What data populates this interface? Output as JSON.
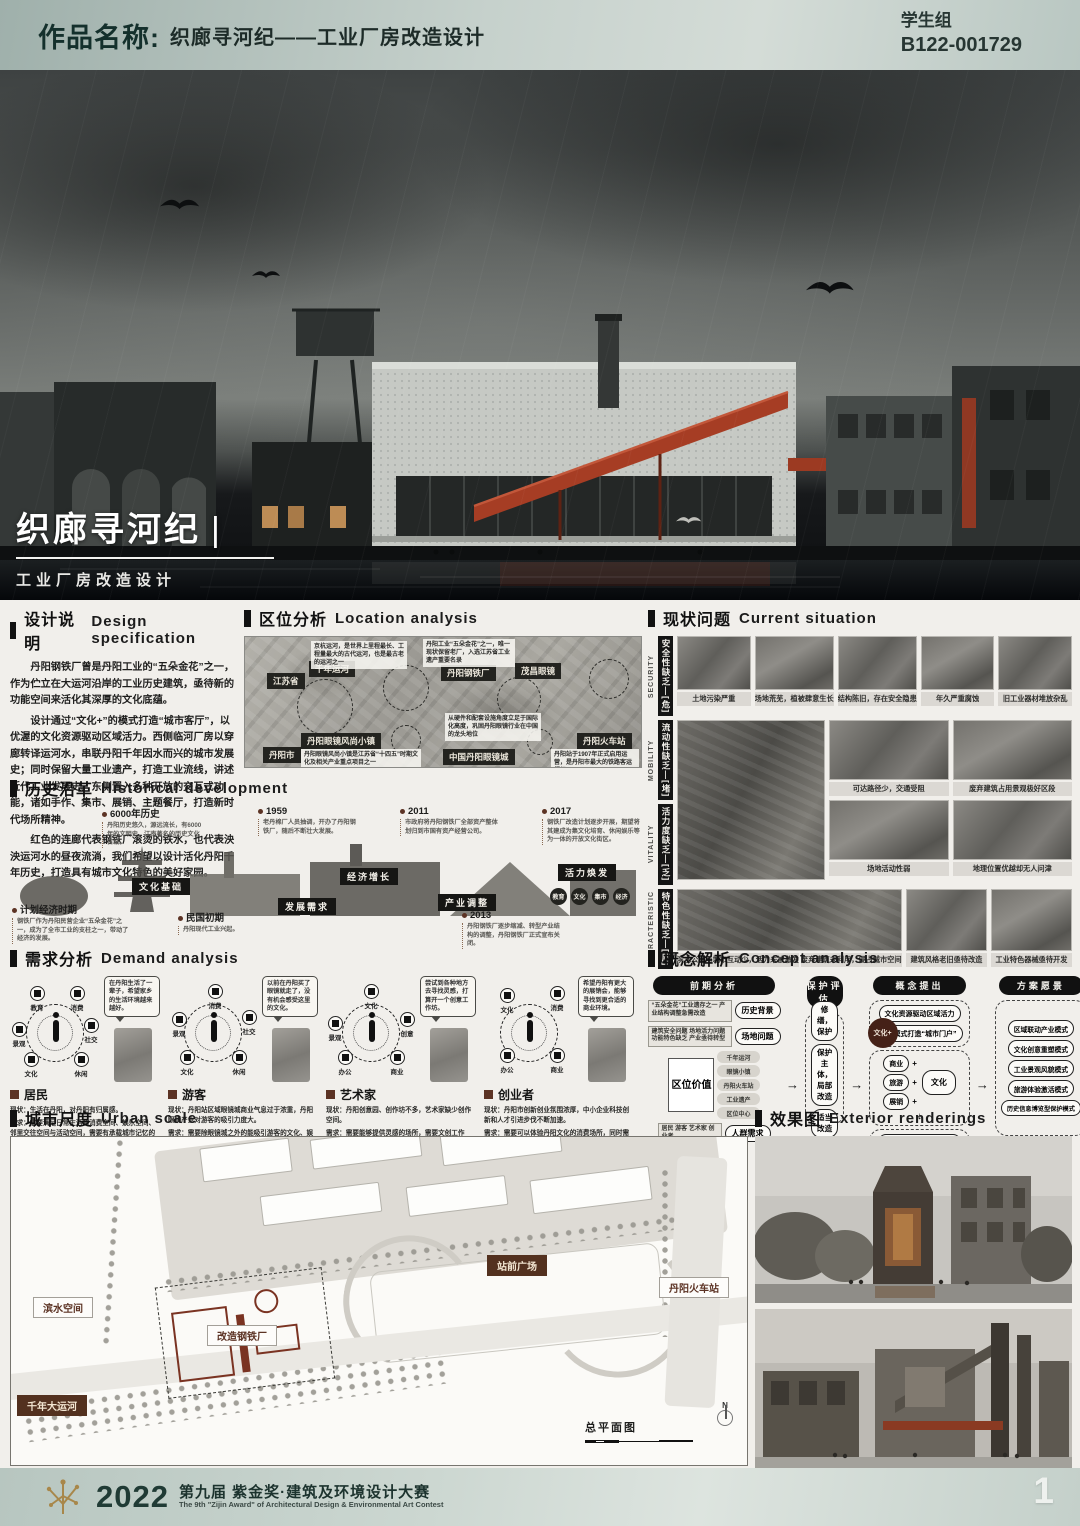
{
  "header": {
    "label": "作品名称:",
    "title": "织廊寻河纪——工业厂房改造设计",
    "group": "学生组",
    "code": "B122-001729"
  },
  "hero": {
    "title": "织廊寻河纪",
    "bar": "|",
    "subtitle": "工业厂房改造设计"
  },
  "design_spec": {
    "zh": "设计说明",
    "en": "Design specification",
    "p1": "丹阳钢铁厂曾是丹阳工业的“五朵金花”之一，作为伫立在大运河沿岸的工业历史建筑，亟待新的功能空间来活化其深厚的文化底蕴。",
    "p2": "设计通过“文化+”的模式打造“城市客厅”，以优渥的文化资源驱动区域活力。西侧临河厂房以穿廊转译运河水，串联丹阳千年因水而兴的城市发展史；同时保留大量工业遗产，打造工业流线，讲述近代工业发展史。东侧置入多种开放的交互式功能，诸如手作、集市、展销、主题餐厅，打造新时代场所精神。",
    "p3": "红色的连廊代表钢铁厂滚烫的铁水，也代表泱泱运河水的昼夜流淌，我们希望以设计活化丹阳千年历史，打造具有城市文化特色的美好家园。"
  },
  "location": {
    "zh": "区位分析",
    "en": "Location analysis",
    "tags": [
      "江苏省",
      "千年运河",
      "丹阳钢铁厂",
      "茂昌眼镜",
      "丹阳火车站",
      "丹阳市",
      "丹阳眼镜风尚小镇",
      "中国丹阳眼镜城"
    ],
    "notes": [
      "京杭运河，是世界上里程最长、工程量最大的古代运河，也是最古老的运河之一",
      "丹阳工业“五朵金花”之一，唯一现状保留老厂，入选江苏省工业遗产重要名录",
      "丹阳眼镜风尚小镇是江苏省“十四五”时期文化及相关产业重点项目之一",
      "从硬件和配套设施角度立足于国际化高度，巩固丹阳眼镜行业在中国的龙头地位",
      "丹阳站于1907年正式启用运营，是丹阳市最大的铁路客运枢纽"
    ]
  },
  "current": {
    "zh": "现状问题",
    "en": "Current situation",
    "rows": [
      {
        "en": "SECURITY",
        "zh": "安全性缺乏—[危]",
        "captions": [
          "土地污染严重",
          "场地荒芜，植被肆意生长",
          "结构陈旧，存在安全隐患",
          "年久严重腐蚀",
          "旧工业器材堆放杂乱"
        ]
      },
      {
        "en": "MOBILITY",
        "zh": "流动性缺乏—[堵]",
        "captions": [
          "可达路径少，交通受阻",
          "废弃建筑占用景观极好区段"
        ]
      },
      {
        "en": "VITALITY",
        "zh": "活力度缺乏—[乏]",
        "captions": [
          "场地活动性弱",
          "地理位置优越却无人问津"
        ]
      },
      {
        "en": "CHARACTERISTIC",
        "zh": "特色性缺乏—[庸]",
        "captions": [
          "滨水公园与城市互动少，活力未被激发",
          "废弃建筑未利用，侵占城市空间",
          "建筑风格老旧亟待改造",
          "工业特色器械亟待开发"
        ]
      }
    ]
  },
  "history": {
    "zh": "历史沿革",
    "en": "Historical development",
    "events": [
      {
        "year": "6000年历史",
        "note": "丹阳历史悠久，源远流长，有6000年的文明史，江南著名的历史文化古城。"
      },
      {
        "year": "民国初期",
        "note": "丹阳现代工业兴起。"
      },
      {
        "year": "1959",
        "note": "老丹棉厂人员抽调，开办了丹阳钢铁厂，随后不断壮大发展。"
      },
      {
        "year": "计划经济时期",
        "note": "钢铁厂作为丹阳民营企业“五朵金花”之一，成为了全市工业的支柱之一，带动了经济的发展。"
      },
      {
        "year": "2011",
        "note": "市政府将丹阳钢铁厂全部资产整体划归到市国有资产经营公司。"
      },
      {
        "year": "2013",
        "note": "丹阳钢铁厂逐步缩减、转型产业结构的调整，丹阳钢铁厂正式宣布关闭。"
      },
      {
        "year": "2017",
        "note": "钢铁厂改造计划逐步开展，期望将其建成为集文化培育、休闲娱乐等为一体的开放文化街区。"
      }
    ],
    "tags": [
      "文化基础",
      "发展需求",
      "经济增长",
      "产业调整",
      "活力焕发"
    ],
    "chips": [
      "教育",
      "文化",
      "集市",
      "经济"
    ]
  },
  "demand": {
    "zh": "需求分析",
    "en": "Demand analysis",
    "personas": [
      {
        "name": "居民",
        "bubble": "在丹阳生活了一辈子，希望家乡的生活环境越来越好。",
        "needs": [
          "教育",
          "消费",
          "景观",
          "社交",
          "文化",
          "休闲"
        ],
        "status": "现状：生活在丹阳，对丹阳有归属感。",
        "demand": "需求：需要满足日常生活的消费空间、娱乐空间、邻里交往空间与活动空间，需要有承载城市记忆的纪念性空间。"
      },
      {
        "name": "游客",
        "bubble": "以前在丹阳买了眼镜就走了，没有机会感受这里的文化。",
        "needs": [
          "消费",
          "景观",
          "社交",
          "文化",
          "休闲"
        ],
        "status": "现状：丹阳站区域眼镜城商业气息过于浓重，丹阳眼镜产业对游客的吸引力度大。",
        "demand": "需求：需要除眼镜城之外的能吸引游客的文化、娱乐空间，需要深度了解丹阳城市文化，感受丹阳城市气质。"
      },
      {
        "name": "艺术家",
        "bubble": "尝试到各种地方去寻找灵感，打算开一个创意工作坊。",
        "needs": [
          "文化",
          "景观",
          "创意",
          "办公",
          "商业"
        ],
        "status": "现状：丹阳创意园、创作坊不多，艺术家缺少创作空间。",
        "demand": "需求：需要能够提供灵感的场所，需要文创工作室，需要有人流量的场所售卖文创产品。"
      },
      {
        "name": "创业者",
        "bubble": "希望丹阳有更大的展销会，能够寻找到更合适的商业环境。",
        "needs": [
          "文化",
          "消费",
          "办公",
          "商业"
        ],
        "status": "现状：丹阳市创新创业氛围浓厚，中小企业科技创新和人才引进步伐不断加速。",
        "demand": "需求：需要可以体验丹阳文化的消费场所，同时需要配套足够的展销空间。"
      }
    ]
  },
  "concept": {
    "zh": "概念解析",
    "en": "Concept analysis",
    "col_headers": [
      "前期分析",
      "保护评估",
      "概念提出",
      "方案愿景"
    ],
    "analysis": [
      {
        "text": "“五朵金花”工业遗存之一 产业结构调整急需改造",
        "pill": "历史背景"
      },
      {
        "text": "建筑安全问题 场地活力问题 功能特色缺乏 产业亟待转型",
        "pill": "场地问题"
      },
      {
        "box": "区位价值",
        "chips": [
          "千年运河",
          "眼镜小镇",
          "丹阳火车站",
          "工业遗产",
          "区位中心"
        ]
      },
      {
        "text": "居民 游客 艺术家 创业者",
        "pill": "人群需求"
      }
    ],
    "protection": [
      "修缮，保护",
      "保护主体，局部改造",
      "适当改造"
    ],
    "proposal_top": [
      "文化资源驱动区域活力",
      "模式打造“城市门户”"
    ],
    "proposal_badge": "文化+",
    "proposal_plus": [
      "商业",
      "旅游",
      "展销"
    ],
    "plus_sign": "+",
    "down_arrow": "↓",
    "proposal_core": "文化",
    "proposal_bottom": [
      "运河文化凝练为空间特征",
      "千年历史浓缩进动线策划",
      "钢铁精神融入街区主题餐厅"
    ],
    "vision_modes": [
      "区域联动产业模式",
      "文化创意重塑模式",
      "工业景观风貌模式",
      "旅游体验激活模式",
      "历史信息博览型保护模式"
    ],
    "vision_final": [
      "提取千年运河文化",
      "打造现代活力家园"
    ]
  },
  "urban": {
    "zh": "城市尺度",
    "en": "Urban scale",
    "labels": [
      "滨水空间",
      "站前广场",
      "丹阳火车站",
      "改造钢铁厂",
      "千年大运河"
    ],
    "plan_label": "总平面图",
    "north": "N"
  },
  "renderings": {
    "zh": "效果图",
    "en": "Exterior renderings"
  },
  "footer": {
    "year": "2022",
    "title_zh": "第九届 紫金奖·建筑及环境设计大赛",
    "title_en": "The 9th \"Zijin Award\" of Architectural Design & Environmental Art Contest",
    "page": "1"
  }
}
